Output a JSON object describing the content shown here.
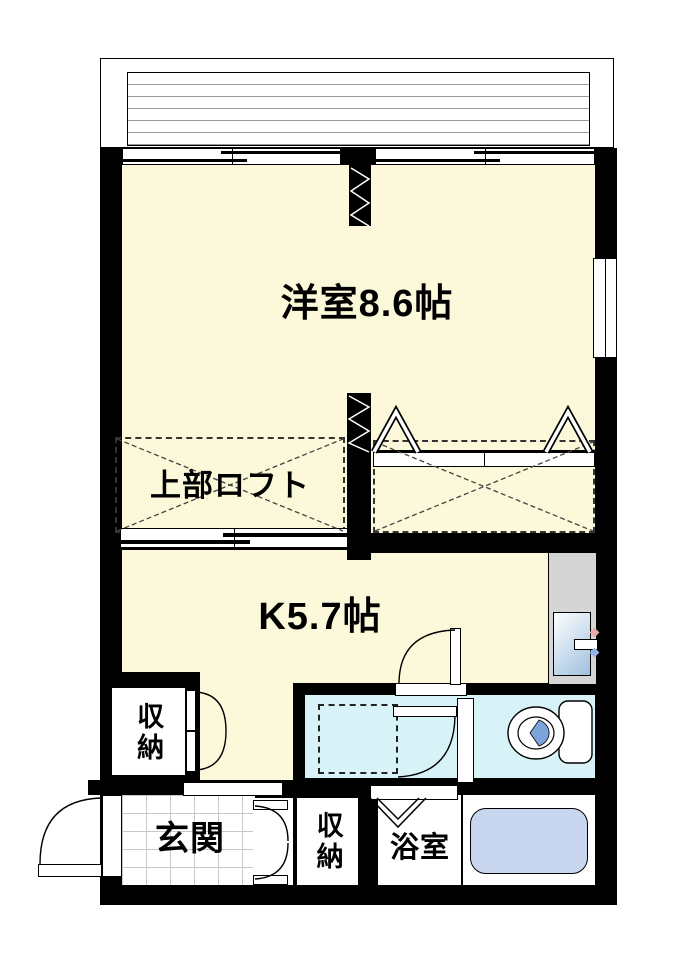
{
  "floorplan": {
    "rooms": {
      "western_room": {
        "label": "洋室8.6帖"
      },
      "loft": {
        "label": "上部ロフト"
      },
      "kitchen": {
        "label": "K5.7帖"
      },
      "storage_kitchen": {
        "label": "収納"
      },
      "storage_entrance": {
        "label": "収納"
      },
      "entrance": {
        "label": "玄関"
      },
      "bathroom": {
        "label": "浴室"
      }
    },
    "colors": {
      "wall": "#000000",
      "room_floor": "#FCF9DA",
      "toilet_room_floor": "#D8F3F8",
      "bathtub": "#C8D6EF",
      "toilet_seat": "#7AA4DA",
      "sink_counter": "#D5D5D5",
      "genkan_tile_line": "#C8C8C8",
      "balcony_line": "#999999"
    }
  }
}
